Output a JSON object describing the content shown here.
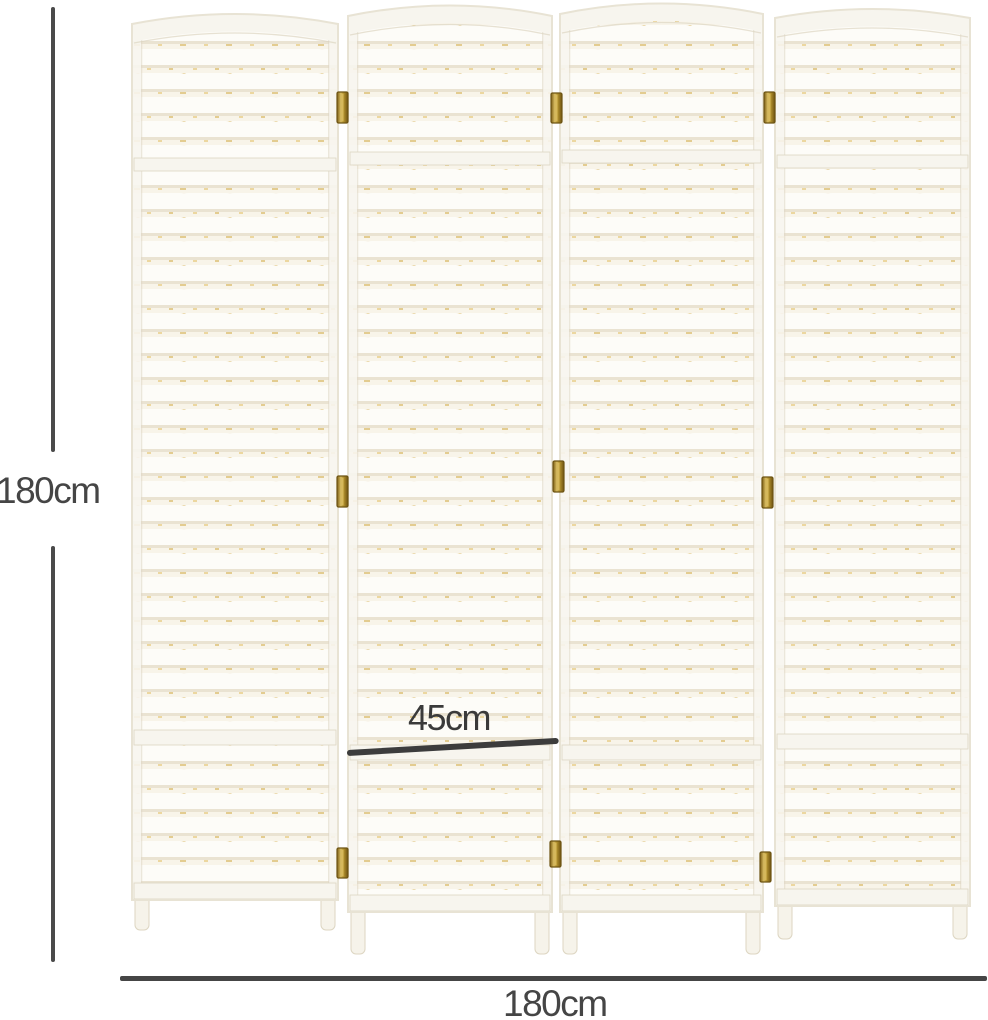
{
  "figure": {
    "title": "four-panel-room-divider-dimension-diagram",
    "background_color": "#ffffff",
    "annotation": {
      "line_color": "#474747",
      "text_color": "#454545",
      "height_label": "180cm",
      "panel_width_label": "45cm",
      "total_width_label": "180cm"
    },
    "divider": {
      "panel_count": 4,
      "panel_base_color": "#f8f4e9",
      "slat_color": "#fdfcf8",
      "slat_shadow_color": "#eae3d2",
      "weave_accent_color": "#ecd7a0",
      "weave_accent_color_2": "#e3cc90",
      "frame_color": "#f7f5ee",
      "frame_edge_color": "#ddd6c2",
      "outline_color": "#e8e3d4",
      "leg_color": "#f6f3ea",
      "hinge_colors": [
        "#7a5c14",
        "#d9bd62",
        "#b5942f",
        "#6d5110"
      ],
      "hinge_border_color": "#6d5413"
    }
  }
}
